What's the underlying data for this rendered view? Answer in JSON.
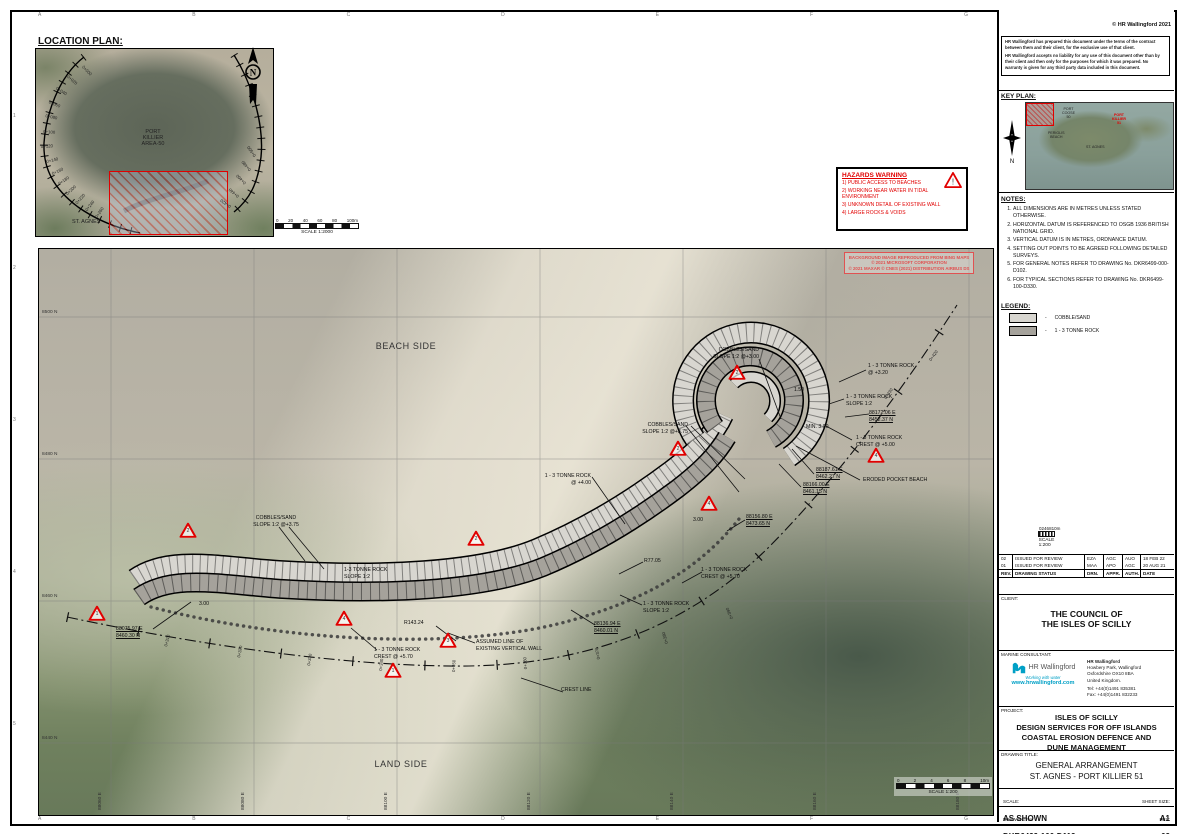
{
  "sheet": {
    "copyright": "© HR Wallingford 2021",
    "frame_letters": [
      "A",
      "B",
      "C",
      "D",
      "E",
      "F",
      "G"
    ],
    "frame_numbers": [
      "1",
      "2",
      "3",
      "4",
      "5"
    ]
  },
  "disclaimer": {
    "p1": "HR Wallingford has prepared this document under the terms of the contract between them and their client, for the exclusive use of that client.",
    "p2": "HR Wallingford accepts no liability for any use of this document other than by their client and then only for the purposes for which it was prepared.  No warranty is given for any third party data included in this document."
  },
  "location_plan": {
    "heading": "LOCATION PLAN:",
    "area_label": "PORT\nKILLIER\nAREA-50",
    "place_label": "ST. AGNES",
    "scale_ticks": [
      "0",
      "20",
      "40",
      "60",
      "80",
      "100m"
    ],
    "scale_text": "SCALE 1:2000",
    "chainage": [
      {
        "text": "0+000",
        "x": 45,
        "y": 14,
        "rot": 45
      },
      {
        "text": "0+020",
        "x": 30,
        "y": 24,
        "rot": 40
      },
      {
        "text": "0+040",
        "x": 19,
        "y": 36,
        "rot": 32
      },
      {
        "text": "0+060",
        "x": 12,
        "y": 50,
        "rot": 22
      },
      {
        "text": "0+080",
        "x": 9,
        "y": 64,
        "rot": 12
      },
      {
        "text": "0+100",
        "x": 7,
        "y": 80,
        "rot": 4
      },
      {
        "text": "0+120",
        "x": 5,
        "y": 95,
        "rot": -4
      },
      {
        "text": "0+140",
        "x": 11,
        "y": 110,
        "rot": -14
      },
      {
        "text": "0+160",
        "x": 17,
        "y": 122,
        "rot": -24
      },
      {
        "text": "0+180",
        "x": 24,
        "y": 132,
        "rot": -34
      },
      {
        "text": "0+200",
        "x": 32,
        "y": 142,
        "rot": -42
      },
      {
        "text": "0+220",
        "x": 42,
        "y": 151,
        "rot": -48
      },
      {
        "text": "0+240",
        "x": 52,
        "y": 158,
        "rot": -52
      },
      {
        "text": "0+260",
        "x": 62,
        "y": 165,
        "rot": -56
      },
      {
        "text": "0+420",
        "x": 196,
        "y": 151,
        "rot": 215
      },
      {
        "text": "0+440",
        "x": 204,
        "y": 141,
        "rot": 220
      },
      {
        "text": "0+460",
        "x": 211,
        "y": 128,
        "rot": 225
      },
      {
        "text": "0+480",
        "x": 216,
        "y": 115,
        "rot": 230
      },
      {
        "text": "0+500",
        "x": 221,
        "y": 101,
        "rot": 235
      }
    ]
  },
  "hazards": {
    "heading": "HAZARDS WARNING",
    "items": [
      "1) PUBLIC ACCESS TO BEACHES",
      "2) WORKING NEAR WATER IN TIDAL ENVIRONMENT",
      "3) UNKNOWN DETAIL OF EXISTING WALL",
      "4) LARGE ROCKS & VOIDS"
    ]
  },
  "attribution": {
    "l1": "BACKGROUND IMAGE REPRODUCED FROM BING MAPS",
    "l2": "© 2021 MICROSOFT CORPORATION",
    "l3": "© 2021 MAXAR © CNES (2021) DISTRIBUTION AIRBUS DS"
  },
  "key_plan": {
    "heading": "KEY PLAN:",
    "label_port_coose": "PORT\nCOOSE\n50",
    "label_port_killier": "PORT\nKILLIER\n51",
    "label_periglis": "PERIGLIS\nBEACH",
    "label_st_agnes": "ST. AGNES"
  },
  "notes": {
    "heading": "NOTES:",
    "items": [
      "ALL DIMENSIONS ARE IN METRES UNLESS STATED OTHERWISE.",
      "HORIZONTAL DATUM IS REFERENCED TO OSGB 1936 BRITISH NATIONAL GRID.",
      "VERTICAL DATUM IS IN METRES, ORDNANCE DATUM.",
      "SETTING OUT POINTS TO BE AGREED FOLLOWING DETAILED SURVEYS.",
      "FOR GENERAL NOTES REFER TO DRAWING No. DKR6499-000-D102.",
      "FOR TYPICAL SECTIONS REFER TO DRAWING No. DKR6499-100-D330."
    ]
  },
  "legend": {
    "heading": "LEGEND:",
    "items": [
      {
        "label": "COBBLE/SAND",
        "swatch": "#d8d6d0"
      },
      {
        "label": "1 - 3 TONNE ROCK",
        "swatch": "#a5a29b"
      }
    ]
  },
  "scalebar200": {
    "ticks": [
      "0",
      "2",
      "4",
      "6",
      "8",
      "10m"
    ],
    "text": "SCALE 1:200"
  },
  "revisions": {
    "headers": [
      "REV.",
      "DRAWING STATUS",
      "DRN.",
      "APPR.",
      "AUTH.",
      "DATE"
    ],
    "rows": [
      {
        "rev": "02",
        "status": "ISSUED FOR REVIEW",
        "drn": "EZA",
        "appr": "AGC",
        "auth": "AUO",
        "date": "18 FEB 22"
      },
      {
        "rev": "01",
        "status": "ISSUED FOR REVIEW",
        "drn": "MAA",
        "appr": "APO",
        "auth": "AGC",
        "date": "20 AUG 21"
      }
    ]
  },
  "client": {
    "label": "CLIENT:",
    "name": "THE COUNCIL OF\nTHE ISLES OF SCILLY"
  },
  "consultant": {
    "label": "MARINE CONSULTANT:",
    "logo_text": "HR Wallingford",
    "tagline": "Working with water",
    "url": "www.hrwallingford.com",
    "addr_name": "HR Wallingford",
    "addr_lines": "Howbery Park, Wallingford\nOxfordshire OX10 8BA\nUnited Kingdom.",
    "tel": "Tel: +44(0)1491 835381",
    "fax": "Fax: +44(0)1491 832233"
  },
  "project": {
    "label": "PROJECT:",
    "text": "ISLES OF SCILLY\nDESIGN SERVICES FOR OFF ISLANDS\nCOASTAL EROSION DEFENCE AND\nDUNE MANAGEMENT"
  },
  "drawing_title": {
    "label": "DRAWING TITLE:",
    "text": "GENERAL ARRANGEMENT\nST. AGNES - PORT KILLIER 51"
  },
  "scale_block": {
    "label": "SCALE:",
    "value": "AS SHOWN",
    "sheet_label": "SHEET SIZE:",
    "sheet_value": "A1"
  },
  "number_block": {
    "label": "DRAWING No:",
    "value": "DKR6499-100-D112",
    "rev_label": "REV:",
    "rev_value": "02"
  },
  "plan": {
    "labels": [
      {
        "text": "BEACH SIDE",
        "x": 367,
        "y": 92,
        "cls": "ca big"
      },
      {
        "text": "LAND SIDE",
        "x": 362,
        "y": 510,
        "cls": "ca big"
      },
      {
        "text": "COBBLES/SAND\nSLOPE 1:2 @+3.00",
        "x": 720,
        "y": 98,
        "cls": "ra"
      },
      {
        "text": "1 - 3 TONNE ROCK\n@ +3.20",
        "x": 829,
        "y": 114,
        "cls": "la"
      },
      {
        "text": "1 - 3 TONNE ROCK\nSLOPE 1:2",
        "x": 807,
        "y": 145,
        "cls": "la"
      },
      {
        "text": "88172.06 E\n8452.37 N",
        "x": 830,
        "y": 161,
        "cls": "la coord"
      },
      {
        "text": "1 - 3 TONNE ROCK\nCREST @ +5.00",
        "x": 817,
        "y": 186,
        "cls": "la"
      },
      {
        "text": "88187.61 E\n8462.27 N",
        "x": 777,
        "y": 218,
        "cls": "la coord"
      },
      {
        "text": "88166.00 E\n8461.15 N",
        "x": 764,
        "y": 233,
        "cls": "la coord"
      },
      {
        "text": "ERODED POCKET BEACH",
        "x": 824,
        "y": 228,
        "cls": "la"
      },
      {
        "text": "1.50",
        "x": 760,
        "y": 138,
        "cls": "ca"
      },
      {
        "text": "MIN. 3.00",
        "x": 767,
        "y": 175,
        "cls": "la"
      },
      {
        "text": "COBBLES/SAND\nSLOPE 1:2 @+3.75",
        "x": 649,
        "y": 173,
        "cls": "ra"
      },
      {
        "text": "1 - 3 TONNE ROCK\n@ +4.00",
        "x": 552,
        "y": 224,
        "cls": "ra"
      },
      {
        "text": "3.00",
        "x": 659,
        "y": 268,
        "cls": "ca"
      },
      {
        "text": "88156.80 E\n8473.65 N",
        "x": 707,
        "y": 265,
        "cls": "la coord"
      },
      {
        "text": "R77.05",
        "x": 605,
        "y": 309,
        "cls": "la"
      },
      {
        "text": "1 - 3 TONNE ROCK\nCREST @ +5.70",
        "x": 662,
        "y": 318,
        "cls": "la"
      },
      {
        "text": "COBBLES/SAND\nSLOPE 1:2 @+3.75",
        "x": 237,
        "y": 266,
        "cls": "ca"
      },
      {
        "text": "1-3 TONNE ROCK\nSLOPE 1:2",
        "x": 305,
        "y": 318,
        "cls": "la"
      },
      {
        "text": "3.00",
        "x": 165,
        "y": 352,
        "cls": "ca"
      },
      {
        "text": "R143.24",
        "x": 365,
        "y": 371,
        "cls": "la"
      },
      {
        "text": "ASSUMED LINE OF\nEXISTING VERTICAL WALL",
        "x": 437,
        "y": 390,
        "cls": "la"
      },
      {
        "text": "1 - 3 TONNE ROCK\nCREST @ +5.70",
        "x": 335,
        "y": 398,
        "cls": "la"
      },
      {
        "text": "1 - 3 TONNE ROCK\nSLOPE 1:2",
        "x": 604,
        "y": 352,
        "cls": "la"
      },
      {
        "text": "88136.94 E\n8460.01 N",
        "x": 555,
        "y": 372,
        "cls": "la coord"
      },
      {
        "text": "88075.97 E\n8460.30 N",
        "x": 77,
        "y": 377,
        "cls": "la coord"
      },
      {
        "text": "CREST LINE",
        "x": 522,
        "y": 438,
        "cls": "la"
      }
    ],
    "triangles": [
      {
        "n": "2",
        "x": 698,
        "y": 124
      },
      {
        "n": "2",
        "x": 639,
        "y": 200
      },
      {
        "n": "4",
        "x": 837,
        "y": 207
      },
      {
        "n": "4",
        "x": 670,
        "y": 255
      },
      {
        "n": "2",
        "x": 437,
        "y": 290
      },
      {
        "n": "2",
        "x": 149,
        "y": 282
      },
      {
        "n": "1",
        "x": 58,
        "y": 365
      },
      {
        "n": "4",
        "x": 305,
        "y": 370
      },
      {
        "n": "3",
        "x": 409,
        "y": 392
      },
      {
        "n": "1",
        "x": 354,
        "y": 422
      }
    ],
    "chainage": [
      {
        "text": "0+310",
        "x": 129,
        "y": 393,
        "rot": -76
      },
      {
        "text": "0+320",
        "x": 202,
        "y": 404,
        "rot": -79
      },
      {
        "text": "0+330",
        "x": 272,
        "y": 412,
        "rot": -81
      },
      {
        "text": "0+340",
        "x": 344,
        "y": 417,
        "rot": -84
      },
      {
        "text": "0+350",
        "x": 417,
        "y": 418,
        "rot": -88
      },
      {
        "text": "0+360",
        "x": 489,
        "y": 415,
        "rot": -94
      },
      {
        "text": "0+370",
        "x": 562,
        "y": 405,
        "rot": -100
      },
      {
        "text": "0+380",
        "x": 630,
        "y": 389,
        "rot": -106
      },
      {
        "text": "0+390",
        "x": 695,
        "y": 364,
        "rot": -113
      },
      {
        "text": "0+420",
        "x": 893,
        "y": 108,
        "rot": -55
      },
      {
        "text": "0+430",
        "x": 848,
        "y": 146,
        "rot": -55
      }
    ],
    "grid_north": [
      {
        "text": "8500 N",
        "x": 3,
        "y": 61
      },
      {
        "text": "8480 N",
        "x": 3,
        "y": 203
      },
      {
        "text": "8460 N",
        "x": 3,
        "y": 345
      },
      {
        "text": "8440 N",
        "x": 3,
        "y": 487
      }
    ],
    "grid_east": [
      {
        "text": "88060 E",
        "x": 64,
        "y": 556
      },
      {
        "text": "88080 E",
        "x": 207,
        "y": 556
      },
      {
        "text": "88100 E",
        "x": 350,
        "y": 556
      },
      {
        "text": "88120 E",
        "x": 493,
        "y": 556
      },
      {
        "text": "88140 E",
        "x": 636,
        "y": 556
      },
      {
        "text": "88160 E",
        "x": 779,
        "y": 556
      },
      {
        "text": "88180 E",
        "x": 922,
        "y": 556
      }
    ]
  }
}
